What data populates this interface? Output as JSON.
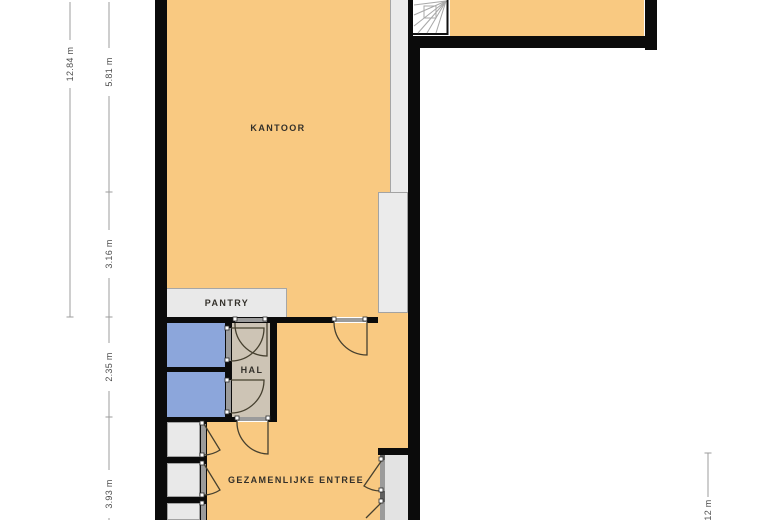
{
  "plan": {
    "type": "floorplan",
    "rooms": {
      "office": {
        "label": "KANTOOR"
      },
      "pantry": {
        "label": "PANTRY"
      },
      "hall": {
        "label": "HAL"
      },
      "entrance": {
        "label": "GEZAMENLIJKE ENTREE"
      }
    },
    "dimensions": {
      "left_outer": "12.84 m",
      "left_inner": [
        "5.81 m",
        "3.16 m",
        "2.35 m",
        "3.93 m"
      ],
      "right": "12 m"
    },
    "colors": {
      "wall": "#0b0b0b",
      "floor_main": "#f9c981",
      "floor_toilet": "#8ca6db",
      "floor_hall": "#cdc4b5",
      "floor_utility": "#e9e9e9",
      "floor_shaft": "#ebebeb",
      "floor_niche": "#e3e3e3",
      "dimension_text": "#4d4d4d"
    }
  }
}
